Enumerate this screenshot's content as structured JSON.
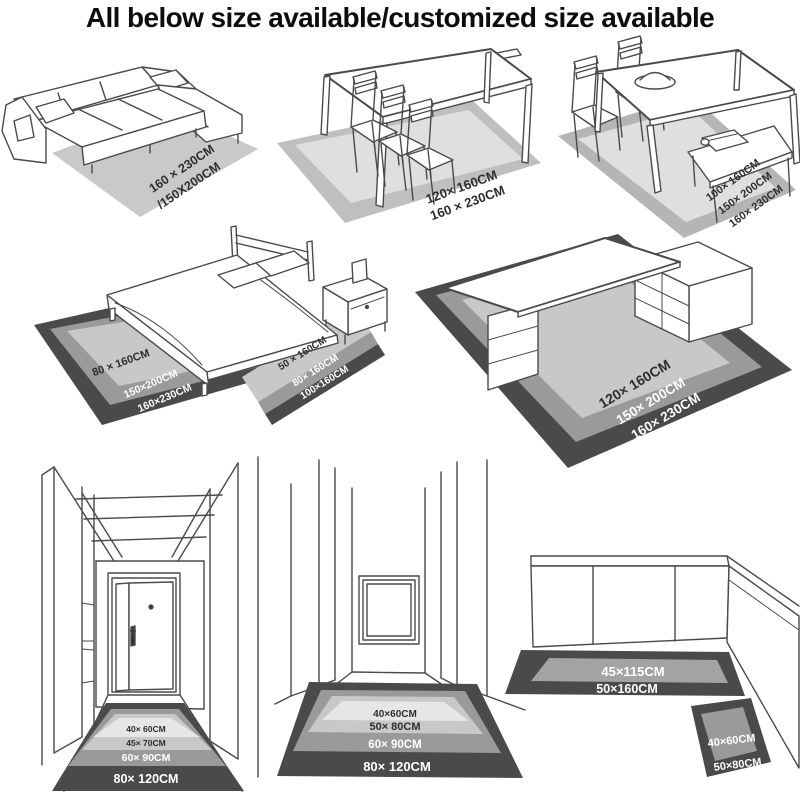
{
  "title": "All below size available/customized size available",
  "sofa": {
    "size1": "160 × 230CM",
    "size2": "/150X200CM"
  },
  "dining": {
    "size1": "120× 160CM",
    "size2": "160 × 230CM"
  },
  "diningSet": {
    "size1": "100× 160CM",
    "size2": "150× 200CM",
    "size3": "160× 230CM"
  },
  "bedArea": {
    "size1": "80 × 160CM",
    "size2": "150×200CM",
    "size3": "160×230CM"
  },
  "bedRunner": {
    "size1": "50 × 160CM",
    "size2": "80× 160CM",
    "size3": "100×160CM"
  },
  "desk": {
    "size1": "120× 160CM",
    "size2": "150× 200CM",
    "size3": "160× 230CM"
  },
  "hallway": {
    "size1": "40× 60CM",
    "size2": "45× 70CM",
    "size3": "60× 90CM",
    "size4": "80× 120CM"
  },
  "corridor": {
    "size1": "40×60CM",
    "size2": "50× 80CM",
    "size3": "60× 90CM",
    "size4": "80× 120CM"
  },
  "kitchenRunner": {
    "size1": "45×115CM",
    "size2": "50×160CM"
  },
  "kitchenMat": {
    "size1": "40×60CM",
    "size2": "50×80CM"
  },
  "colors": {
    "line": "#4a4a4a",
    "textDark": "#2e2e2e",
    "textLight": "#ffffff",
    "rugPlain": "#c9c9c9",
    "rugBorder": "#bfbfbf",
    "rugInner": "#dfdfdf",
    "rugSetBorder": "#b5b5b5",
    "rugDark": "#4a4a4a",
    "rugMid": "#9a9a9a",
    "rugLight": "#c8c8c8",
    "rugPale": "#e6e6e6",
    "kitchenMid": "#a3a3a3"
  }
}
